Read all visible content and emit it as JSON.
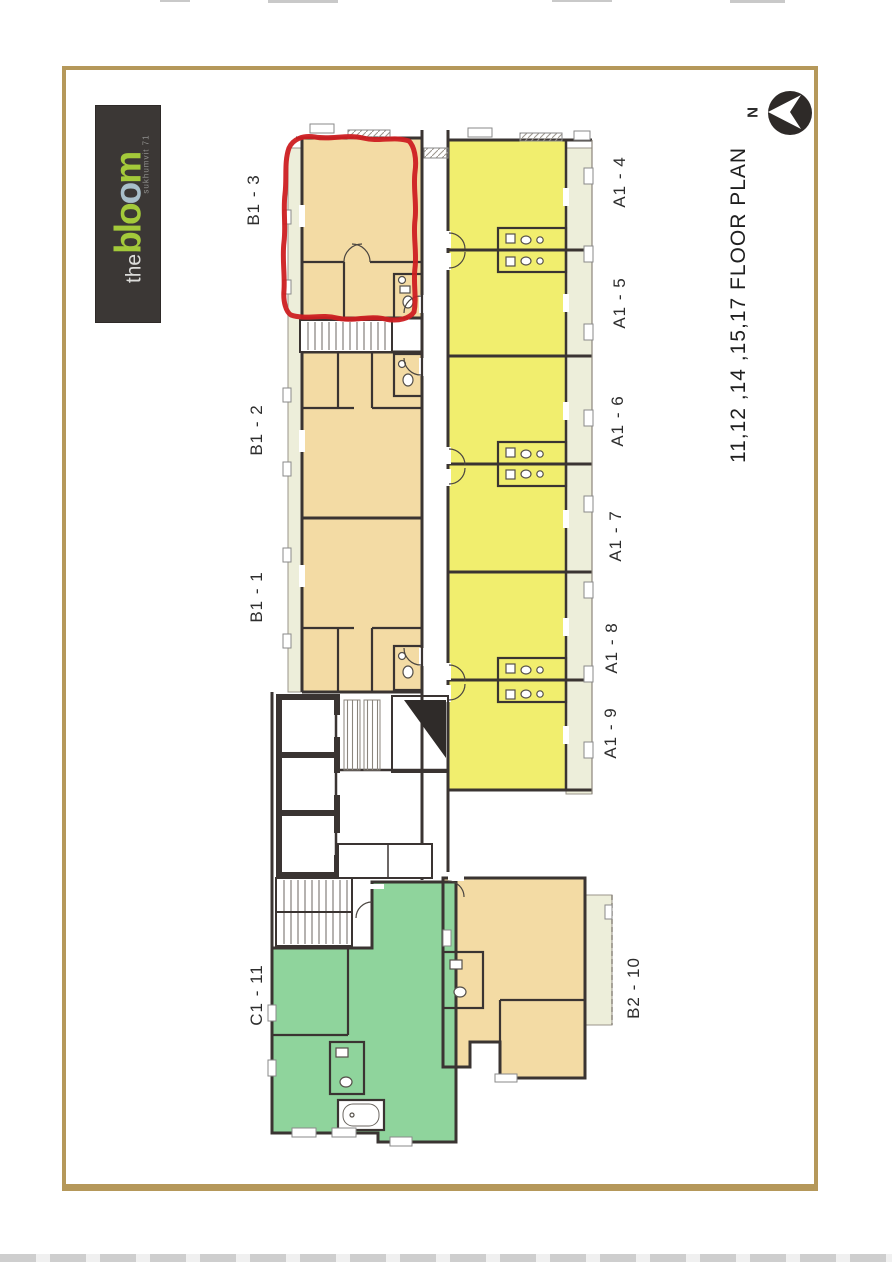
{
  "logo": {
    "prefix": "the",
    "brand_part1": "blo",
    "brand_part2": "o",
    "brand_part3": "m",
    "subtitle": "sukhumvit 71",
    "colors": {
      "background": "#3b3735",
      "prefix": "#dcdcda",
      "brand_green": "#a3c93a",
      "accent_o_blue": "#a9bfca"
    }
  },
  "compass": {
    "north_label": "N"
  },
  "plan_title": {
    "text": "11,12 ,14 ,15,17  FLOOR  PLAN"
  },
  "units": [
    {
      "label": "B1 - 3",
      "color": "#f3dba4",
      "highlighted": true
    },
    {
      "label": "B1 - 2",
      "color": "#f3dba4",
      "highlighted": false
    },
    {
      "label": "B1 - 1",
      "color": "#f3dba4",
      "highlighted": false
    },
    {
      "label": "A1 - 4",
      "color": "#f1ee6e",
      "highlighted": false
    },
    {
      "label": "A1 - 5",
      "color": "#f1ee6e",
      "highlighted": false
    },
    {
      "label": "A1 - 6",
      "color": "#f1ee6e",
      "highlighted": false
    },
    {
      "label": "A1 - 7",
      "color": "#f1ee6e",
      "highlighted": false
    },
    {
      "label": "A1 - 8",
      "color": "#f1ee6e",
      "highlighted": false
    },
    {
      "label": "A1 - 9",
      "color": "#f1ee6e",
      "highlighted": false
    },
    {
      "label": "B2 - 10",
      "color": "#f3dba4",
      "highlighted": false
    },
    {
      "label": "C1 - 11",
      "color": "#8fd49c",
      "highlighted": false
    }
  ],
  "highlight": {
    "unit": "B1 - 3",
    "outline_color": "#ce1f22"
  },
  "palette": {
    "frame_border": "#b5985a",
    "walls": "#3a3432",
    "balcony": "#edeeda",
    "paper": "#ffffff"
  }
}
